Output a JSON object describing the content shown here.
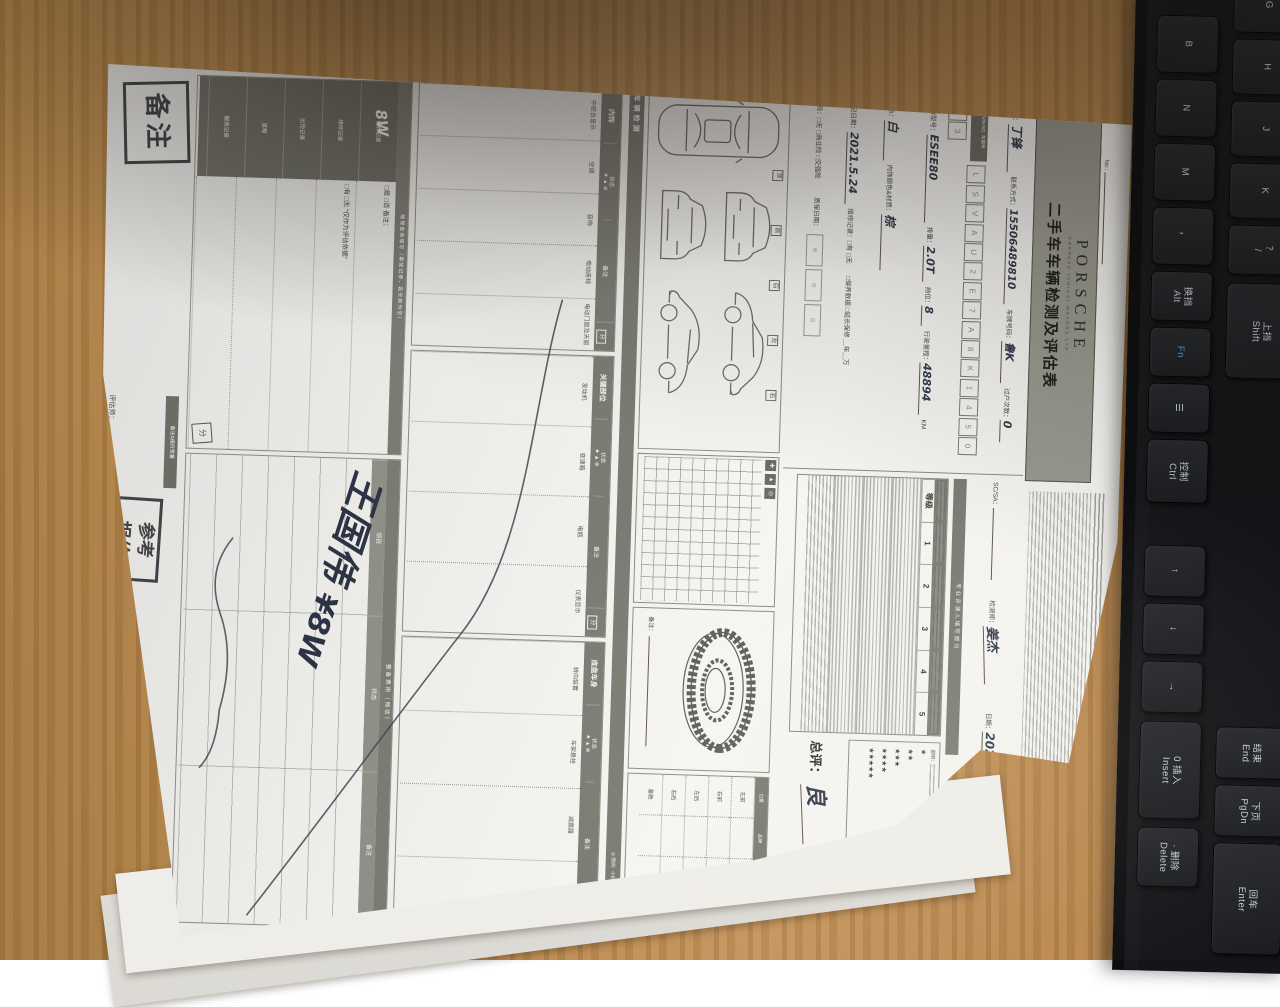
{
  "scene": {
    "desk_color": "#b8884c",
    "paper_color": "#f4f3f0",
    "keyboard_color": "#141518"
  },
  "form": {
    "doc_no_label": "No.:",
    "header": {
      "brand": "PORSCHE",
      "brand_sub": "PORSCHE (CHINA) MOTORS LTD.",
      "title": "二手车车辆检测及评估表"
    },
    "info": {
      "name_label": "姓名：",
      "name": "丁锋",
      "phone_label": "联系方式：",
      "phone": "15506489810",
      "plate_label": "车牌号码：",
      "plate": "鲁K",
      "transfers_label": "过户次数：",
      "transfers": "0",
      "vin_label": "VIN NO. 车架号",
      "vin_chars": [
        "L",
        "S",
        "V",
        "A",
        "U",
        "2",
        "E",
        "7",
        "A",
        "8",
        "K",
        "1",
        "4",
        "5",
        "0",
        "7",
        "3"
      ],
      "model_label": "品牌型号：",
      "model": "ESEE80",
      "displacement_label": "排量：",
      "displacement": "2.0T",
      "gear_label": "挡位：",
      "gear": "8",
      "mileage_label": "行驶里程：",
      "mileage": "48894",
      "mileage_unit": "KM",
      "color_label": "颜色：",
      "color": "白",
      "interior_label": "内饰颜色&材质：",
      "interior": "棕",
      "register_label": "登记日期：",
      "register_date": "2021.5.24",
      "repair_label": "维修记录：",
      "repair_options": "□有 □无",
      "maintain_options": "□保养数据 □延长保修 ＿年＿万",
      "insurance_label": "保险：",
      "insurance_options": "□无 □商业险 □交强险",
      "warranty_label": "质保日期：",
      "warranty_units": [
        "年",
        "月",
        "日"
      ]
    },
    "pro": {
      "sc_label": "SC/SA：",
      "inspector_label": "检测师：",
      "inspector": "姜杰",
      "date_label": "日期：",
      "date": "2025.8.6",
      "divider": "专业评测人填写部分",
      "grading_cols": [
        "等级",
        "1",
        "2",
        "3",
        "4",
        "5"
      ],
      "stars_note": "说明：",
      "stars": [
        {
          "s": "★",
          "v": "6-11分"
        },
        {
          "s": "★★",
          "v": "12-17分"
        },
        {
          "s": "★★★",
          "v": "18-23分"
        },
        {
          "s": "★★★★",
          "v": "24-29分"
        },
        {
          "s": "★★★★★",
          "v": "30-35分"
        }
      ],
      "overall_label": "总评：",
      "overall": "良"
    },
    "inspection": {
      "section_title": "车辆检测",
      "legend": "◎ 图例：①划痕 ②凹陷 ③锈蚀 ④更换",
      "car_tags": [
        "顶",
        "前",
        "后",
        "左",
        "右"
      ],
      "grid_symbols": [
        "✚",
        "▲",
        "◎"
      ],
      "tire_note_label": "备注：",
      "tire_table": {
        "headers": [
          "位置",
          "品牌",
          "尺寸",
          "生产/磨损"
        ],
        "rows": [
          "左前",
          "右前",
          "左后",
          "右后",
          "备胎"
        ]
      }
    },
    "item_tables": [
      {
        "title": "内饰",
        "items": [
          "中控台显示",
          "空调",
          "音响",
          "电动座椅",
          "电动门窗及天窗"
        ]
      },
      {
        "title": "关键部位",
        "items": [
          "发动机",
          "变速箱",
          "电瓶",
          "仪表显示"
        ]
      },
      {
        "title": "底盘车身",
        "items": [
          "转向装置",
          "车架悬挂",
          "减震器",
          "制动系统"
        ]
      }
    ],
    "table_common": {
      "status_label": "状态",
      "symbols": "★ ▲ ⊗",
      "note_label": "备注",
      "score_label": "分"
    },
    "service_box": {
      "title": "维保查询填写（事故记录，若无则为空）",
      "row_labels": [
        "保养记录",
        "维修记录",
        "出险记录",
        "里程",
        "服务记录"
      ],
      "hand_note": "8W",
      "body_rows": [
        "□是 □否 备注：",
        "□有 □无 “仅作为评估依据”",
        "",
        "",
        ""
      ]
    },
    "cost_box": {
      "title": "整备费用（预估）",
      "headers": [
        "项目",
        "状态",
        "备注"
      ]
    },
    "footer": {
      "remark_stamp": "备注",
      "sign_strip": "备注&报价签署",
      "quote_stamp_line1": "参考",
      "quote_stamp_line2": "报价",
      "hand_price": "¥8W",
      "hand_sign": "王国伟",
      "assessor_label": "评估师：",
      "date_label": "日期："
    }
  },
  "keyboard": {
    "keys": [
      {
        "c": 1,
        "y": -14,
        "h": 56,
        "l": "G"
      },
      {
        "c": 1,
        "y": 48,
        "h": 56,
        "l": "H"
      },
      {
        "c": 1,
        "y": 110,
        "h": 56,
        "l": "J"
      },
      {
        "c": 1,
        "y": 172,
        "h": 56,
        "l": "K"
      },
      {
        "c": 1,
        "y": 234,
        "h": 50,
        "l": "？\n/"
      },
      {
        "c": 1,
        "y": 292,
        "h": 96,
        "l": "上挡\nShift"
      },
      {
        "c": 1,
        "y": 736,
        "h": 52,
        "l": "结束\nEnd"
      },
      {
        "c": 1,
        "y": 794,
        "h": 52,
        "l": "下页\nPgDn"
      },
      {
        "c": 1,
        "y": 852,
        "h": 112,
        "l": "回车\nEnter"
      },
      {
        "c": 0,
        "y": 26,
        "h": 58,
        "l": "B"
      },
      {
        "c": 0,
        "y": 90,
        "h": 58,
        "l": "N"
      },
      {
        "c": 0,
        "y": 154,
        "h": 58,
        "l": "M"
      },
      {
        "c": 0,
        "y": 218,
        "h": 58,
        "l": "，"
      },
      {
        "c": 0,
        "y": 282,
        "h": 50,
        "l": "换挡\nAlt"
      },
      {
        "c": 0,
        "y": 338,
        "h": 50,
        "l": "Fn"
      },
      {
        "c": 0,
        "y": 394,
        "h": 50,
        "l": "☰"
      },
      {
        "c": 0,
        "y": 450,
        "h": 64,
        "l": "控制\nCtrl"
      },
      {
        "c": 0,
        "y": 556,
        "h": 52,
        "l": "↑"
      },
      {
        "c": 0,
        "y": 614,
        "h": 52,
        "l": "↓"
      },
      {
        "c": 0,
        "y": 672,
        "h": 52,
        "l": "→"
      },
      {
        "c": 0,
        "y": 732,
        "h": 98,
        "l": "0 插入\nInsert"
      },
      {
        "c": 0,
        "y": 838,
        "h": 60,
        "l": "· 删除\nDelete"
      }
    ]
  }
}
